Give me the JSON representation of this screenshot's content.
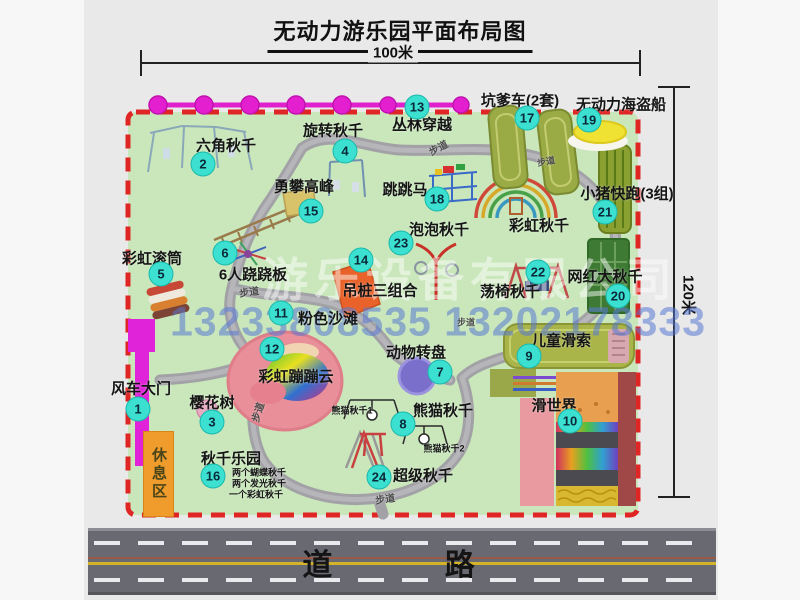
{
  "title": "无动力游乐园平面布局图",
  "dimensions": {
    "horizontal": "100米",
    "vertical": "120米"
  },
  "road": {
    "label": "道  路"
  },
  "watermark": {
    "company": "游乐设备有限公司",
    "phone": "13233808535 13202178333"
  },
  "colors": {
    "map_bg": "#c9e7bb",
    "border_red": "#e02525",
    "badge_cyan": "#3ce0d0",
    "gate_magenta": "#e022d8",
    "rest_area_orange": "#f09c2c",
    "road_gray": "#696971",
    "path_gray": "#a5a5a8"
  },
  "map": {
    "rest_area": {
      "label": "休息区"
    },
    "items": [
      {
        "n": "1",
        "label": "风车大门",
        "bx": 138,
        "by": 409,
        "lx": 141,
        "ly": 388
      },
      {
        "n": "2",
        "label": "六角秋千",
        "bx": 203,
        "by": 164,
        "lx": 226,
        "ly": 145
      },
      {
        "n": "3",
        "label": "樱花树",
        "bx": 212,
        "by": 422,
        "lx": 212,
        "ly": 402
      },
      {
        "n": "4",
        "label": "旋转秋千",
        "bx": 345,
        "by": 151,
        "lx": 333,
        "ly": 130
      },
      {
        "n": "5",
        "label": "彩虹滚筒",
        "bx": 161,
        "by": 274,
        "lx": 152,
        "ly": 258
      },
      {
        "n": "6",
        "label": "6人跷跷板",
        "bx": 225,
        "by": 253,
        "lx": 253,
        "ly": 274
      },
      {
        "n": "7",
        "label": "动物转盘",
        "bx": 440,
        "by": 372,
        "lx": 416,
        "ly": 352
      },
      {
        "n": "8",
        "label": "熊猫秋千",
        "bx": 403,
        "by": 424,
        "lx": 443,
        "ly": 410
      },
      {
        "n": "9",
        "label": "儿童滑索",
        "bx": 529,
        "by": 356,
        "lx": 561,
        "ly": 340
      },
      {
        "n": "10",
        "label": "滑世界",
        "bx": 570,
        "by": 421,
        "lx": 554,
        "ly": 405
      },
      {
        "n": "11",
        "label": "粉色沙滩",
        "bx": 281,
        "by": 313,
        "lx": 328,
        "ly": 318
      },
      {
        "n": "12",
        "label": "彩虹蹦蹦云",
        "bx": 272,
        "by": 349,
        "lx": 296,
        "ly": 376
      },
      {
        "n": "13",
        "label": "丛林穿越",
        "bx": 417,
        "by": 107,
        "lx": 422,
        "ly": 124
      },
      {
        "n": "14",
        "label": "吊桩三组合",
        "bx": 361,
        "by": 260,
        "lx": 380,
        "ly": 290
      },
      {
        "n": "15",
        "label": "勇攀高峰",
        "bx": 311,
        "by": 211,
        "lx": 304,
        "ly": 186
      },
      {
        "n": "16",
        "label": "秋千乐园",
        "bx": 213,
        "by": 476,
        "lx": 231,
        "ly": 458
      },
      {
        "n": "17",
        "label": "坑爹车(2套)",
        "bx": 527,
        "by": 118,
        "lx": 520,
        "ly": 100
      },
      {
        "n": "18",
        "label": "跳跳马",
        "bx": 437,
        "by": 199,
        "lx": 405,
        "ly": 189
      },
      {
        "n": "19",
        "label": "无动力海盗船",
        "bx": 589,
        "by": 120,
        "lx": 621,
        "ly": 104
      },
      {
        "n": "20",
        "label": "网红大秋千",
        "bx": 618,
        "by": 296,
        "lx": 605,
        "ly": 276
      },
      {
        "n": "21",
        "label": "小猪快跑(3组)",
        "bx": 605,
        "by": 212,
        "lx": 627,
        "ly": 193
      },
      {
        "n": "22",
        "label": "荡椅秋千",
        "bx": 538,
        "by": 272,
        "lx": 510,
        "ly": 291
      },
      {
        "n": "23",
        "label": "泡泡秋千",
        "bx": 401,
        "by": 243,
        "lx": 439,
        "ly": 229
      },
      {
        "n": "24",
        "label": "超级秋千",
        "bx": 379,
        "by": 477,
        "lx": 423,
        "ly": 475
      }
    ],
    "texts": [
      {
        "name": "equip-label-rainbow-swing",
        "t": "彩虹秋千",
        "x": 539,
        "y": 225,
        "s": 15
      },
      {
        "name": "equip-sublabel-panda-1",
        "t": "熊猫秋千1",
        "x": 352,
        "y": 410,
        "s": 9
      },
      {
        "name": "equip-sublabel-panda-2",
        "t": "熊猫秋千2",
        "x": 444,
        "y": 448,
        "s": 9
      },
      {
        "name": "swing-note-1",
        "t": "两个蝴蝶秋千",
        "x": 259,
        "y": 472,
        "s": 9
      },
      {
        "name": "swing-note-2",
        "t": "两个发光秋千",
        "x": 259,
        "y": 483,
        "s": 9
      },
      {
        "name": "swing-note-3",
        "t": "一个彩虹秋千",
        "x": 256,
        "y": 494,
        "s": 9
      },
      {
        "name": "path-label",
        "t": "步道",
        "x": 438,
        "y": 147,
        "s": 10,
        "r": -28,
        "c": "#4c4c4c"
      },
      {
        "name": "path-label",
        "t": "步道",
        "x": 546,
        "y": 161,
        "s": 9,
        "r": -10,
        "c": "#4c4c4c"
      },
      {
        "name": "path-label",
        "t": "步道",
        "x": 249,
        "y": 291,
        "s": 10,
        "r": -8,
        "c": "#4c4c4c"
      },
      {
        "name": "path-label",
        "t": "步道",
        "x": 466,
        "y": 322,
        "s": 9,
        "r": 0,
        "c": "#4c4c4c"
      },
      {
        "name": "path-label",
        "t": "步道",
        "x": 257,
        "y": 412,
        "s": 10,
        "r": -72,
        "c": "#4c4c4c"
      },
      {
        "name": "path-label",
        "t": "步道",
        "x": 385,
        "y": 498,
        "s": 10,
        "r": -8,
        "c": "#4c4c4c"
      }
    ]
  }
}
